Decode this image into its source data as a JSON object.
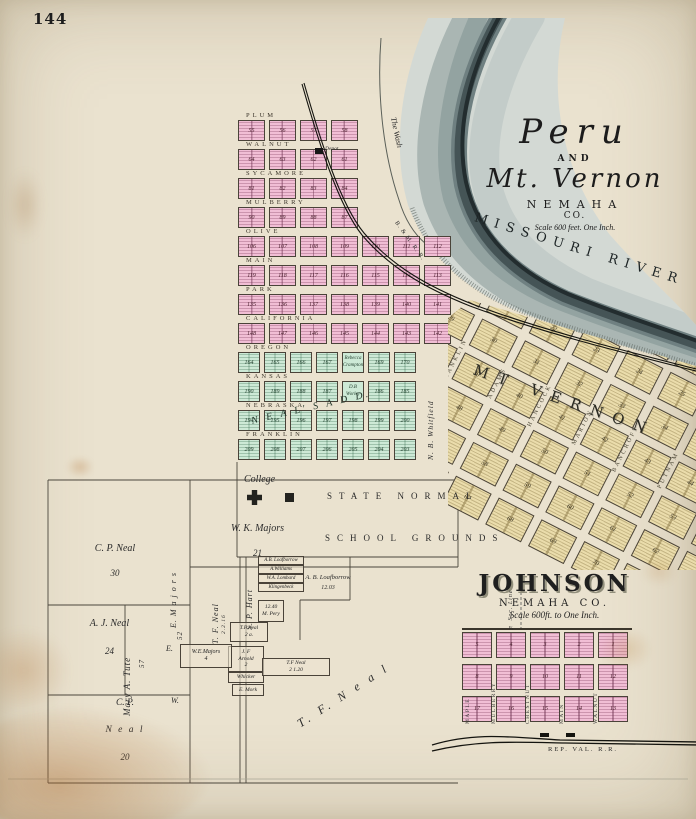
{
  "page": {
    "number": "144"
  },
  "peru_title": {
    "name1": "Peru",
    "and": "AND",
    "name2": "Mt. Vernon",
    "county": "NEMAHA",
    "co": "CO.",
    "scale": "Scale 600 feet. One Inch."
  },
  "river": {
    "name": "MISSOURI RIVER",
    "wash": "The Wash"
  },
  "railroads": {
    "main": "B. & M. R. R.",
    "rep_val": "REP. VAL. R.R."
  },
  "peru_plat": {
    "rows": [
      {
        "street": "PLUM",
        "tint": "pink",
        "blocks": [
          "55",
          "56",
          "57",
          "58"
        ]
      },
      {
        "street": "WALNUT",
        "tint": "pink",
        "blocks": [
          "64",
          "63",
          "62",
          "61"
        ]
      },
      {
        "street": "SYCAMORE",
        "tint": "pink",
        "blocks": [
          "81",
          "82",
          "83",
          "84"
        ]
      },
      {
        "street": "MULBERRY",
        "tint": "pink",
        "blocks": [
          "90",
          "89",
          "88",
          "87"
        ]
      },
      {
        "street": "OLIVE",
        "tint": "pink",
        "blocks": [
          "106",
          "107",
          "108",
          "109",
          "110",
          "111",
          "112"
        ]
      },
      {
        "street": "MAIN",
        "tint": "pink",
        "blocks": [
          "119",
          "118",
          "117",
          "116",
          "115",
          "114",
          "113"
        ]
      },
      {
        "street": "PARK",
        "tint": "pink",
        "blocks": [
          "135",
          "136",
          "137",
          "138",
          "139",
          "140",
          "141"
        ]
      },
      {
        "street": "CALIFORNIA",
        "tint": "pink",
        "blocks": [
          "148",
          "147",
          "146",
          "145",
          "144",
          "143",
          "142"
        ]
      },
      {
        "street": "OREGON",
        "tint": "green",
        "blocks": [
          "164",
          "165",
          "166",
          "167",
          "Rebecca Crampton",
          "169",
          "170"
        ]
      },
      {
        "street": "KANSAS",
        "tint": "green",
        "blocks": [
          "190",
          "189",
          "188",
          "187",
          "D.B Worley",
          "186",
          "185"
        ]
      },
      {
        "street": "NEBRASKA",
        "tint": "green",
        "blocks": [
          "194",
          "195",
          "196",
          "197",
          "198",
          "199",
          "200"
        ]
      },
      {
        "street": "FRANKLIN",
        "tint": "green",
        "blocks": [
          "209",
          "208",
          "207",
          "206",
          "205",
          "204",
          "203"
        ]
      }
    ],
    "addition": "N E A L' S   A D D.",
    "whitfield": "N. B. Whitfield",
    "depot": "Depot"
  },
  "school": {
    "college": "College",
    "grounds1": "STATE NORMAL",
    "grounds2": "SCHOOL GROUNDS"
  },
  "mt_vernon": {
    "title": "MT VERNON",
    "streets": [
      "WASHINGTON",
      "FRANKLIN",
      "ADAMS",
      "HANCOCK",
      "MARION",
      "BANCROFT",
      "PUTNAM"
    ],
    "blocks": [
      1,
      2,
      3,
      4,
      5,
      6,
      7,
      8,
      9,
      10,
      11,
      12,
      13,
      14,
      15,
      16,
      17,
      18,
      19,
      20,
      21,
      22,
      23,
      24,
      25,
      26,
      27,
      28,
      29,
      30,
      31,
      32,
      33,
      34,
      35,
      36,
      37,
      38,
      39,
      40,
      41,
      42,
      43,
      44,
      45,
      46,
      47,
      48,
      49,
      50,
      51,
      52,
      53,
      54,
      55,
      56,
      57,
      58,
      59,
      60,
      61,
      62,
      63,
      64,
      65,
      66,
      67,
      68,
      69,
      70,
      71,
      72
    ]
  },
  "johnson": {
    "title": "JOHNSON",
    "county": "NEMAHA CO.",
    "scale": "Scale 600ft. to One Inch.",
    "sec_line": "¼ Sec. Line",
    "streets": [
      "MAPLE",
      "MULBERRY",
      "CHESTNUT",
      "MAIN",
      "WALNUT"
    ],
    "rows": [
      [
        "5",
        "4",
        "3",
        "2",
        "1"
      ],
      [
        "8",
        "9",
        "10",
        "11",
        "12"
      ],
      [
        "17",
        "16",
        "15",
        "14",
        "13"
      ]
    ]
  },
  "parcels": {
    "cp_neal_30": {
      "name": "C. P. Neal",
      "acres": "30"
    },
    "wk_majors_21": {
      "name": "W. K. Majors",
      "acres": "21"
    },
    "aj_neal": {
      "name": "A. J. Neal",
      "acres": "24"
    },
    "cp_neal_20": {
      "l1": "C. P.",
      "l2": "N e a l",
      "l3": "20"
    },
    "mary_tute": {
      "name": "Mary  A.  Tute",
      "acres": "57"
    },
    "e_majors": {
      "name": "E.  M a j o r s",
      "acres": "52"
    },
    "dir_e": "E.",
    "dir_w": "W.",
    "tf_neal_strip": {
      "name": "T. F. Neal",
      "acres": "2.2.16"
    },
    "sp_hart": "S. P. Hart",
    "stack": [
      "A.B. Loafborrow",
      "A.Williams",
      "W.A. Lombard",
      "Klingenbeck"
    ],
    "loafborrow": {
      "name": "A. B. Loafborrow",
      "acres": "12.03"
    },
    "popy": {
      "acres": "12.40",
      "name": "M. Pery"
    },
    "tf_neal_2a": {
      "name": "T.F.Neal",
      "acres": "2 a."
    },
    "jf_arnold": {
      "l1": "J. F",
      "l2": "Arnold",
      "l3": "2"
    },
    "whicker": "Whicker",
    "we_majors": {
      "name": "W.E.Majors",
      "acres": "4"
    },
    "tf_neal_120": {
      "name": "T.F Neal",
      "acres": "2  1.20"
    },
    "e_mork": "E. Mork",
    "tf_neal_big": "T.  F.  N e a l"
  },
  "colors": {
    "pink": "#f1bed5",
    "green": "#cde9d6",
    "sand": "#eadcab",
    "water_light": "#d3d9d4",
    "water_dark": "#1e2729",
    "paper": "#eae2cf"
  }
}
